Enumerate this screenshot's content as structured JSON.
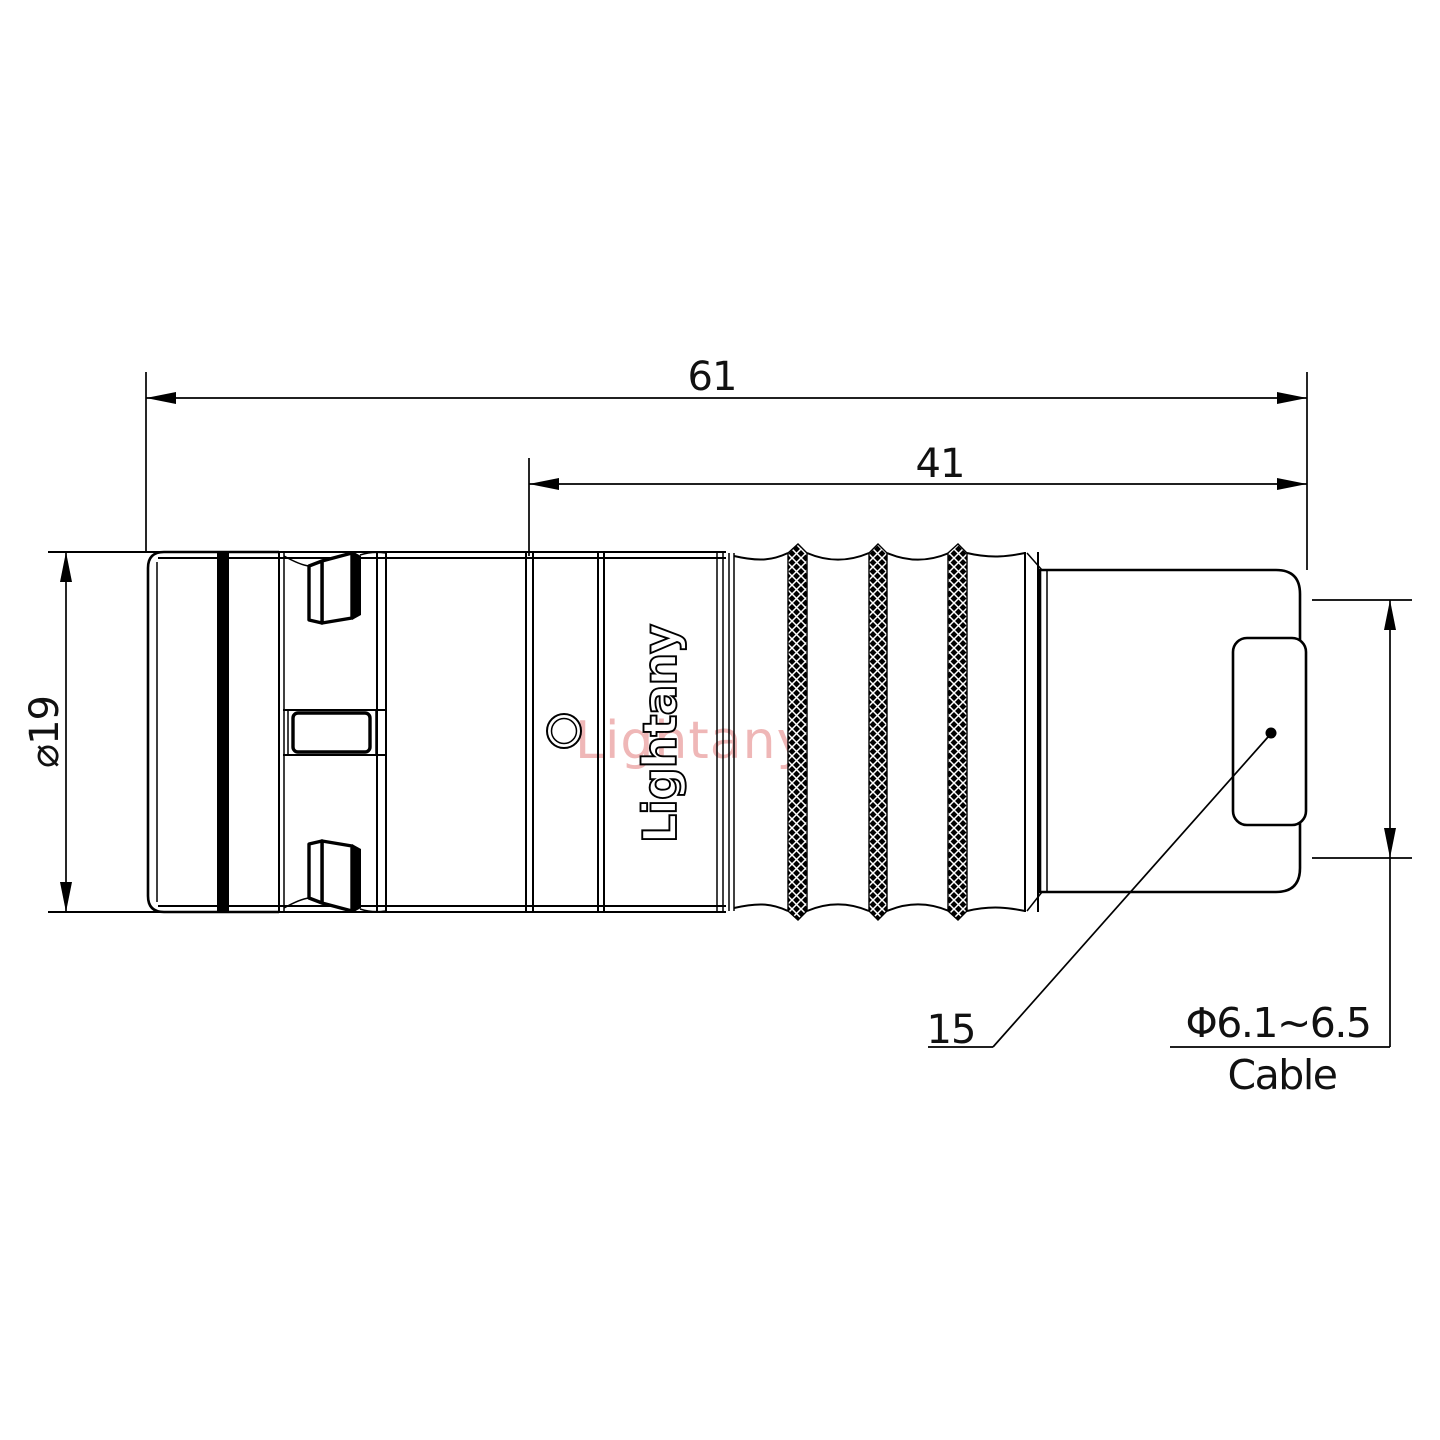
{
  "drawing": {
    "dimensions": {
      "overall_length": "61",
      "rear_length": "41",
      "body_diameter": "⌀19",
      "nut_size": "15",
      "cable_diameter": "Φ6.1~6.5",
      "cable_word": "Cable"
    },
    "brand_text": "Lightany",
    "watermark_text": "Lightany",
    "colors": {
      "line": "#000000",
      "background": "#ffffff",
      "watermark": "#efb7b7"
    }
  }
}
